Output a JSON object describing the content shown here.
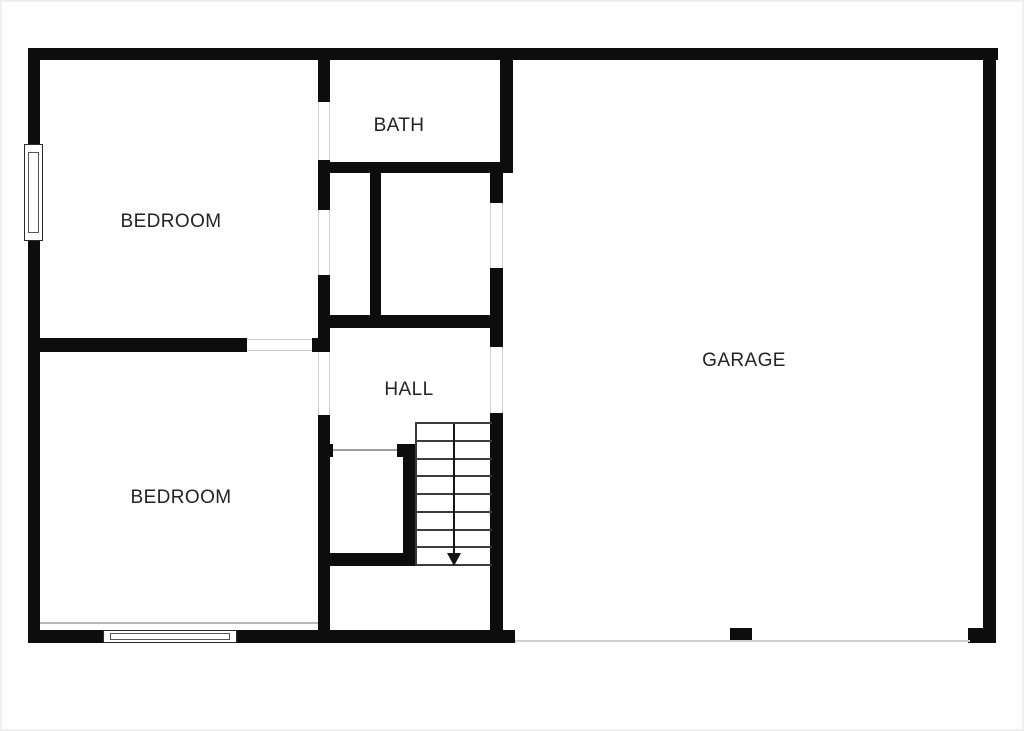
{
  "meta": {
    "type": "floor-plan",
    "background_color": "#ffffff",
    "wall_color": "#0d0d0d",
    "label_color": "#232323"
  },
  "floorplan": {
    "rooms": [
      {
        "id": "bedroom-top",
        "label": "BEDROOM",
        "cx": 171,
        "cy": 222
      },
      {
        "id": "bath",
        "label": "BATH",
        "cx": 399,
        "cy": 126
      },
      {
        "id": "bedroom-bottom",
        "label": "BEDROOM",
        "cx": 181,
        "cy": 498
      },
      {
        "id": "hall",
        "label": "HALL",
        "cx": 409,
        "cy": 390
      },
      {
        "id": "garage",
        "label": "GARAGE",
        "cx": 744,
        "cy": 361
      }
    ],
    "walls": [
      {
        "x": 28,
        "y": 48,
        "w": 970,
        "h": 12
      },
      {
        "x": 28,
        "y": 48,
        "w": 12,
        "h": 97
      },
      {
        "x": 28,
        "y": 240,
        "w": 12,
        "h": 403
      },
      {
        "x": 983,
        "y": 48,
        "w": 13,
        "h": 595
      },
      {
        "x": 28,
        "y": 630,
        "w": 487,
        "h": 13
      },
      {
        "x": 968,
        "y": 628,
        "w": 28,
        "h": 15
      },
      {
        "x": 730,
        "y": 628,
        "w": 22,
        "h": 14
      },
      {
        "x": 318,
        "y": 60,
        "w": 12,
        "h": 42
      },
      {
        "x": 318,
        "y": 160,
        "w": 12,
        "h": 50
      },
      {
        "x": 318,
        "y": 275,
        "w": 12,
        "h": 77
      },
      {
        "x": 318,
        "y": 415,
        "w": 12,
        "h": 220
      },
      {
        "x": 28,
        "y": 338,
        "w": 219,
        "h": 14
      },
      {
        "x": 312,
        "y": 338,
        "w": 18,
        "h": 14
      },
      {
        "x": 322,
        "y": 162,
        "w": 191,
        "h": 11
      },
      {
        "x": 500,
        "y": 60,
        "w": 13,
        "h": 113
      },
      {
        "x": 370,
        "y": 173,
        "w": 11,
        "h": 155
      },
      {
        "x": 322,
        "y": 315,
        "w": 173,
        "h": 13
      },
      {
        "x": 490,
        "y": 173,
        "w": 13,
        "h": 30
      },
      {
        "x": 490,
        "y": 268,
        "w": 13,
        "h": 79
      },
      {
        "x": 490,
        "y": 413,
        "w": 13,
        "h": 230
      },
      {
        "x": 403,
        "y": 444,
        "w": 12,
        "h": 122
      },
      {
        "x": 397,
        "y": 444,
        "w": 18,
        "h": 13
      },
      {
        "x": 318,
        "y": 444,
        "w": 15,
        "h": 13
      },
      {
        "x": 318,
        "y": 553,
        "w": 97,
        "h": 13
      }
    ],
    "thin_lines": [
      {
        "x": 40,
        "y": 622,
        "w": 278,
        "h": 2,
        "c": "#b9b9b9"
      },
      {
        "x": 515,
        "y": 640,
        "w": 455,
        "h": 2,
        "c": "#cfcfcf"
      },
      {
        "x": 333,
        "y": 449,
        "w": 64,
        "h": 2,
        "c": "#9f9f9f"
      },
      {
        "x": 247,
        "y": 339,
        "w": 65,
        "h": 1,
        "c": "#cccccc"
      },
      {
        "x": 247,
        "y": 350,
        "w": 65,
        "h": 1,
        "c": "#cccccc"
      },
      {
        "x": 318,
        "y": 102,
        "w": 1,
        "h": 58,
        "c": "#d4d4d4"
      },
      {
        "x": 329,
        "y": 102,
        "w": 1,
        "h": 58,
        "c": "#d4d4d4"
      },
      {
        "x": 318,
        "y": 210,
        "w": 1,
        "h": 65,
        "c": "#d4d4d4"
      },
      {
        "x": 329,
        "y": 210,
        "w": 1,
        "h": 65,
        "c": "#d4d4d4"
      },
      {
        "x": 318,
        "y": 352,
        "w": 1,
        "h": 63,
        "c": "#d4d4d4"
      },
      {
        "x": 329,
        "y": 352,
        "w": 1,
        "h": 63,
        "c": "#d4d4d4"
      },
      {
        "x": 490,
        "y": 203,
        "w": 1,
        "h": 65,
        "c": "#d4d4d4"
      },
      {
        "x": 502,
        "y": 203,
        "w": 1,
        "h": 65,
        "c": "#d4d4d4"
      },
      {
        "x": 490,
        "y": 347,
        "w": 1,
        "h": 66,
        "c": "#d4d4d4"
      },
      {
        "x": 502,
        "y": 347,
        "w": 1,
        "h": 66,
        "c": "#d4d4d4"
      }
    ],
    "windows": [
      {
        "x": 24,
        "y": 144,
        "w": 19,
        "h": 97,
        "orient": "v"
      },
      {
        "x": 103,
        "y": 630,
        "w": 134,
        "h": 13,
        "orient": "h"
      }
    ],
    "stairs": {
      "x": 415,
      "y": 422,
      "w": 77,
      "h": 144,
      "steps": 8,
      "arrow_x": 38,
      "direction": "down"
    }
  }
}
